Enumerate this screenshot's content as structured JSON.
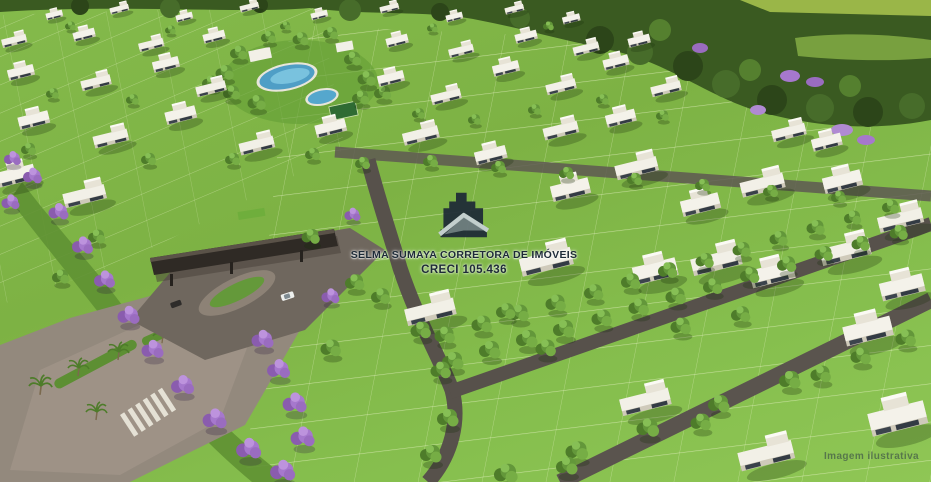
{
  "image": {
    "alt": "Aerial 3D render of a residential land development with green lots, white modern houses, tree-lined streets, purple flowering trees, a gated entrance and a club area with pools"
  },
  "watermark": {
    "logo_icon": "house-logo-icon",
    "line1": "SELMA SUMAYA CORRETORA DE IMÓVEIS",
    "line2": "CRECI 105.436",
    "text_color": "#1d2a37"
  },
  "footer": {
    "note": "Imagem ilustrativa"
  },
  "palette": {
    "grass": "#7db244",
    "grass_light": "#8fc655",
    "forest": "#3a5a21",
    "tree_green": "#63973a",
    "purple_tree": "#a678cd",
    "street_gray": "#56504a",
    "entry_road_tan": "#958a7e",
    "pool_blue": "#55a7cd",
    "house_white": "#f4f2ea",
    "gate_roof": "#2f2a25",
    "lot_line": "#f2f7d9"
  }
}
